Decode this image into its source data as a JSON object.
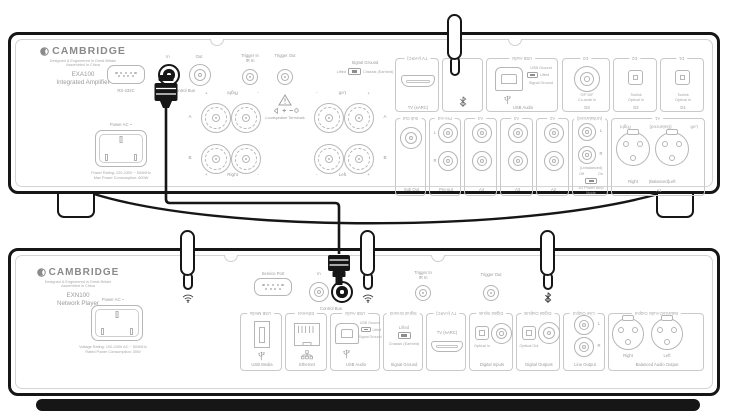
{
  "amp": {
    "brand": "CAMBRIDGE",
    "origin1": "Designed & Engineered in Great Britain",
    "origin2": "Assembled in China",
    "model": "EXA100",
    "model_type": "Integrated Amplifier",
    "rs232": "RS-232C",
    "cb": {
      "in": "In",
      "out": "Out",
      "label": "Control Bus"
    },
    "trigger": {
      "in": "Trigger In",
      "ir": "IR In",
      "out": "Trigger Out"
    },
    "sg": {
      "title": "Signal Ground",
      "lifted": "Lifted",
      "chassis": "Chassis (Earthed)"
    },
    "spk": {
      "plus": "+",
      "minus": "-",
      "right": "Right",
      "left": "Left",
      "a": "A",
      "b": "B",
      "warning": "Loudspeaker Terminals"
    },
    "power": {
      "title": "Power AC ~",
      "line1": "Power Rating: 220-230V ~ 50/60Hz",
      "line2": "Max Power Consumption: 600W"
    },
    "tv": "TV (eARC)",
    "usb": {
      "label": "USB Audio",
      "gnd": "USB Ground",
      "lifted": "Lifted",
      "signal": "Signal Ground"
    },
    "d3": {
      "l1": "S/P DIF",
      "l2": "Co-axial In",
      "label": "D3"
    },
    "d2": {
      "l1": "Toslink",
      "l2": "Optical In",
      "label": "D2"
    },
    "d1": {
      "l1": "Toslink",
      "l2": "Optical In",
      "label": "D1"
    },
    "sub": "Sub Out",
    "pre": "Pre-out",
    "a4": "A4",
    "a3": "A3",
    "a2": "A2",
    "ch": {
      "l": "L",
      "r": "R"
    },
    "a1": {
      "unbal": "(Unbalanced)",
      "off": "Off",
      "on": "On",
      "mode1": "A1 Power Amp",
      "mode2": "Mode",
      "right": "Right",
      "bal": "(Balanced)",
      "left": "Left",
      "label": "A1"
    }
  },
  "player": {
    "brand": "CAMBRIDGE",
    "origin1": "Designed & Engineered in Great Britain",
    "origin2": "Assembled in China",
    "model": "EXN100",
    "model_type": "Network Player",
    "power": {
      "title": "Power AC ~",
      "line1": "Voltage Rating: 100-240V AC ~ 50/60Hz",
      "line2": "Rated Power Consumption: 30W"
    },
    "service": "Service Port",
    "cb": {
      "in": "In",
      "label": "Control Bus"
    },
    "trigger": {
      "in": "Trigger In",
      "ir": "IR In",
      "out": "Trigger Out"
    },
    "usb_media": "USB Media",
    "ethernet": "Ethernet",
    "usb": {
      "label": "USB Audio",
      "gnd": "USB Ground",
      "lifted": "Lifted",
      "signal": "Signal Ground"
    },
    "sg": {
      "label": "Signal Ground",
      "lifted": "Lifted",
      "chassis": "Chassis (Earthed)"
    },
    "tv": "TV (eARC)",
    "din": {
      "opt": "Optical In",
      "label": "Digital Inputs"
    },
    "dout": {
      "opt": "Optical Out",
      "label": "Digital Outputs"
    },
    "line": {
      "l": "L",
      "r": "R",
      "label": "Line Output"
    },
    "bal": {
      "right": "Right",
      "left": "Left",
      "label": "Balanced Audio Output"
    }
  }
}
